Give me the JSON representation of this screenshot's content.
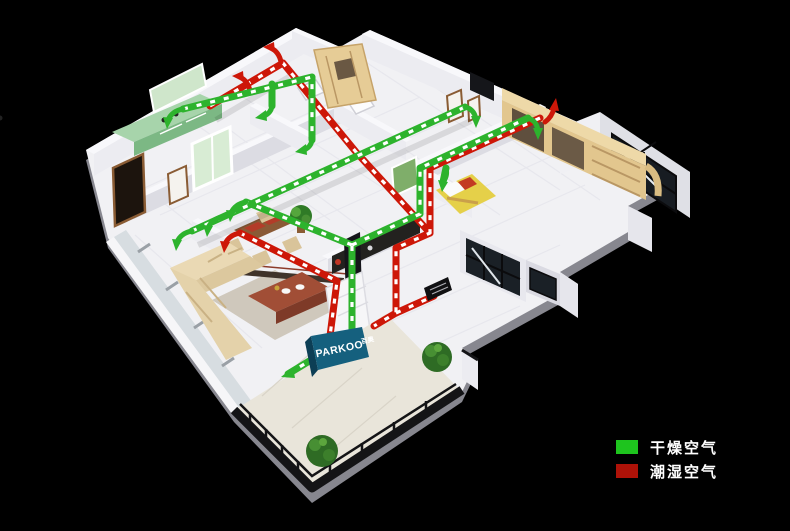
{
  "scene": {
    "description": "3D isometric cutaway of an apartment showing a ducted ventilation and dehumidification system; green ducts carry dry air to rooms, red ducts extract humid air",
    "background_color": "#000000"
  },
  "unit": {
    "brand": "PARKOO",
    "brand_cn": "百奥",
    "banner_color": "#15607e"
  },
  "ducts": {
    "dry_air_color": "#2db32d",
    "humid_air_color": "#cd1708",
    "arrow_dash_color": "#ffffff"
  },
  "legend": {
    "items": [
      {
        "id": "dry-air",
        "label": "干燥空气",
        "color": "#1ec41e"
      },
      {
        "id": "humid-air",
        "label": "潮湿空气",
        "color": "#ae1208"
      }
    ]
  }
}
